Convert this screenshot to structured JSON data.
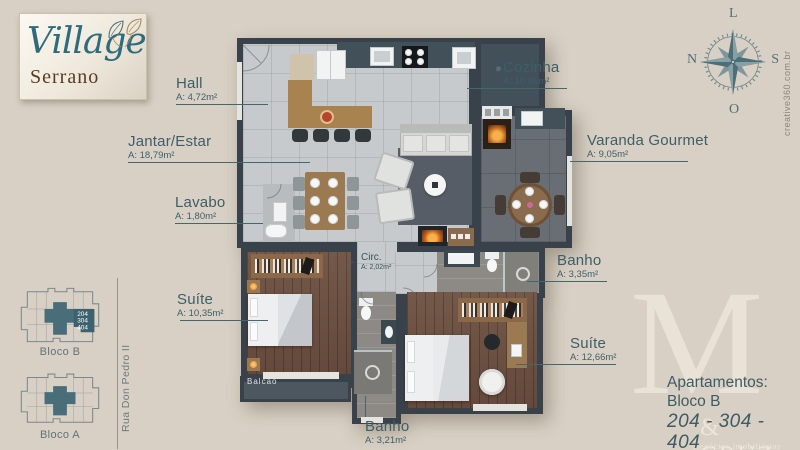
{
  "logo": {
    "title": "Village",
    "subtitle": "Serrano"
  },
  "compass": {
    "top": "L",
    "left": "N",
    "right": "S",
    "bottom": "O"
  },
  "credit": "creative360.com.br",
  "labels": {
    "hall": {
      "name": "Hall",
      "area": "A: 4,72m²"
    },
    "jantar_estar": {
      "name": "Jantar/Estar",
      "area": "A: 18,79m²"
    },
    "lavabo": {
      "name": "Lavabo",
      "area": "A: 1,80m²"
    },
    "cozinha": {
      "name": "Cozinha",
      "area": "A: 10,81m²"
    },
    "varanda_gourmet": {
      "name": "Varanda Gourmet",
      "area": "A: 9,05m²"
    },
    "banho_social": {
      "name": "Banho",
      "area": "A: 3,35m²"
    },
    "suite_2": {
      "name": "Suíte",
      "area": "A: 12,66m²"
    },
    "suite_1": {
      "name": "Suíte",
      "area": "A: 10,35m²"
    },
    "banho_suite": {
      "name": "Banho",
      "area": "A: 3,21m²"
    },
    "circ": {
      "name": "Circ.",
      "area": "A: 2,02m²"
    },
    "balcao": {
      "name": "Balcão"
    }
  },
  "site_plan": {
    "street": "Rua Don Pedro II",
    "bloco_b": {
      "label": "Bloco B",
      "units": [
        "204",
        "304",
        "404"
      ]
    },
    "bloco_a": {
      "label": "Bloco A"
    }
  },
  "apartment_info": {
    "title": "Apartamentos:",
    "block": "Bloco B",
    "units": "204 - 304 - 404",
    "area": "A: 87,45m²"
  },
  "watermark": {
    "monogram": "M",
    "name": "& CRUZ",
    "tagline": "Negócios imobiliários"
  }
}
